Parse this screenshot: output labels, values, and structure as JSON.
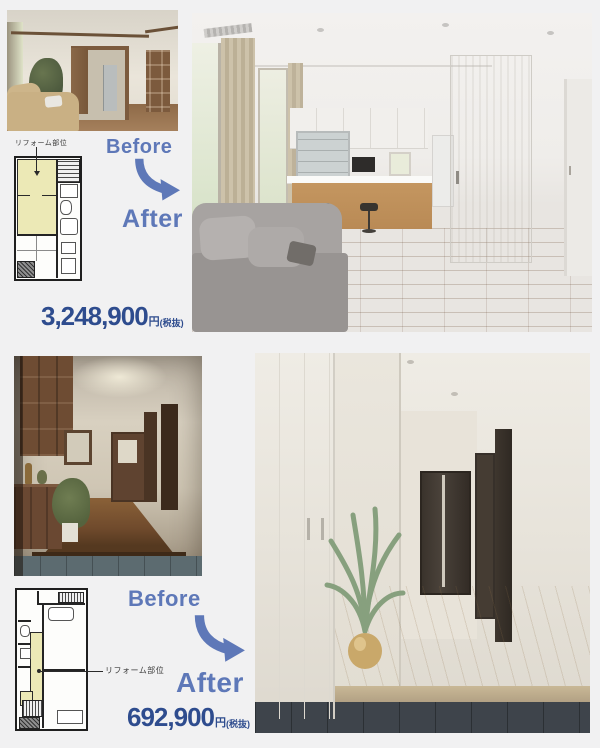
{
  "colors": {
    "accent_blue": "#5e78b8",
    "price_navy": "#2e4c8e",
    "plan_highlight": "#ece9b6",
    "page_bg": "#f1f1f2"
  },
  "sections": [
    {
      "name": "living-dining-kitchen-renovation",
      "plan_label": "リフォーム部位",
      "before_label": "Before",
      "after_label": "After",
      "price_amount": "3,248,900",
      "price_unit": "円",
      "price_tax_note": "(税抜)"
    },
    {
      "name": "entrance-hallway-renovation",
      "plan_label": "リフォーム部位",
      "before_label": "Before",
      "after_label": "After",
      "price_amount": "692,900",
      "price_unit": "円",
      "price_tax_note": "(税抜)"
    }
  ]
}
